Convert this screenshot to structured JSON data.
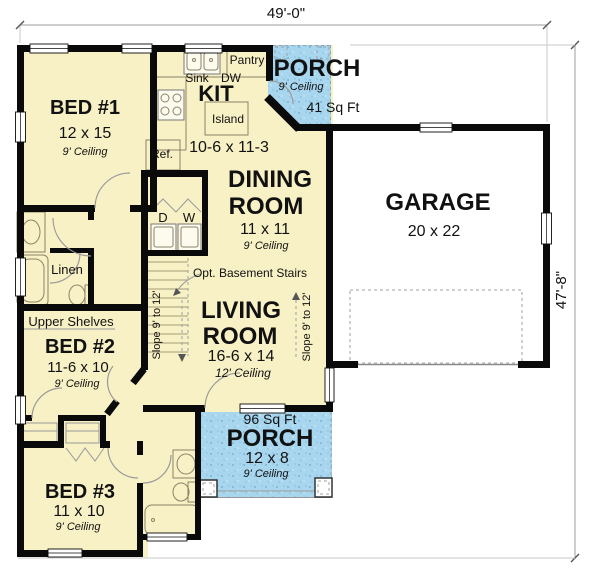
{
  "dimensions": {
    "width": "49'-0\"",
    "height": "47'-8\""
  },
  "rooms": {
    "bed1": {
      "name": "BED #1",
      "size": "12 x 15",
      "ceiling": "9' Ceiling"
    },
    "kitchen": {
      "name": "KIT",
      "size": "10-6 x 11-3",
      "sink": "Sink",
      "dishwasher": "DW",
      "pantry": "Pantry",
      "island": "Island",
      "refrigerator": "Ref."
    },
    "porch_top": {
      "name": "PORCH",
      "ceiling": "9' Ceiling",
      "area": "41 Sq Ft"
    },
    "dining": {
      "name1": "DINING",
      "name2": "ROOM",
      "size": "11 x 11",
      "ceiling": "9' Ceiling"
    },
    "garage": {
      "name": "GARAGE",
      "size": "20 x 22"
    },
    "laundry": {
      "dryer": "D",
      "washer": "W"
    },
    "hall": {
      "linen": "Linen",
      "stairs_note": "Opt. Basement Stairs"
    },
    "living": {
      "name1": "LIVING",
      "name2": "ROOM",
      "size": "16-6 x 14",
      "ceiling": "12' Ceiling",
      "slope_left": "Slope 9' to 12'",
      "slope_right": "Slope 9' to 12'"
    },
    "bed2": {
      "shelves": "Upper Shelves",
      "name": "BED #2",
      "size": "11-6 x 10",
      "ceiling": "9' Ceiling"
    },
    "porch_bottom": {
      "area": "96 Sq Ft",
      "name": "PORCH",
      "size": "12 x 8",
      "ceiling": "9' Ceiling"
    },
    "bed3": {
      "name": "BED #3",
      "size": "11 x 10",
      "ceiling": "9' Ceiling"
    }
  },
  "colors": {
    "floor": "#f8f1c5",
    "porch": "#a7d6ee",
    "wall": "#0a0a0a",
    "dim": "#9c9c9c"
  }
}
